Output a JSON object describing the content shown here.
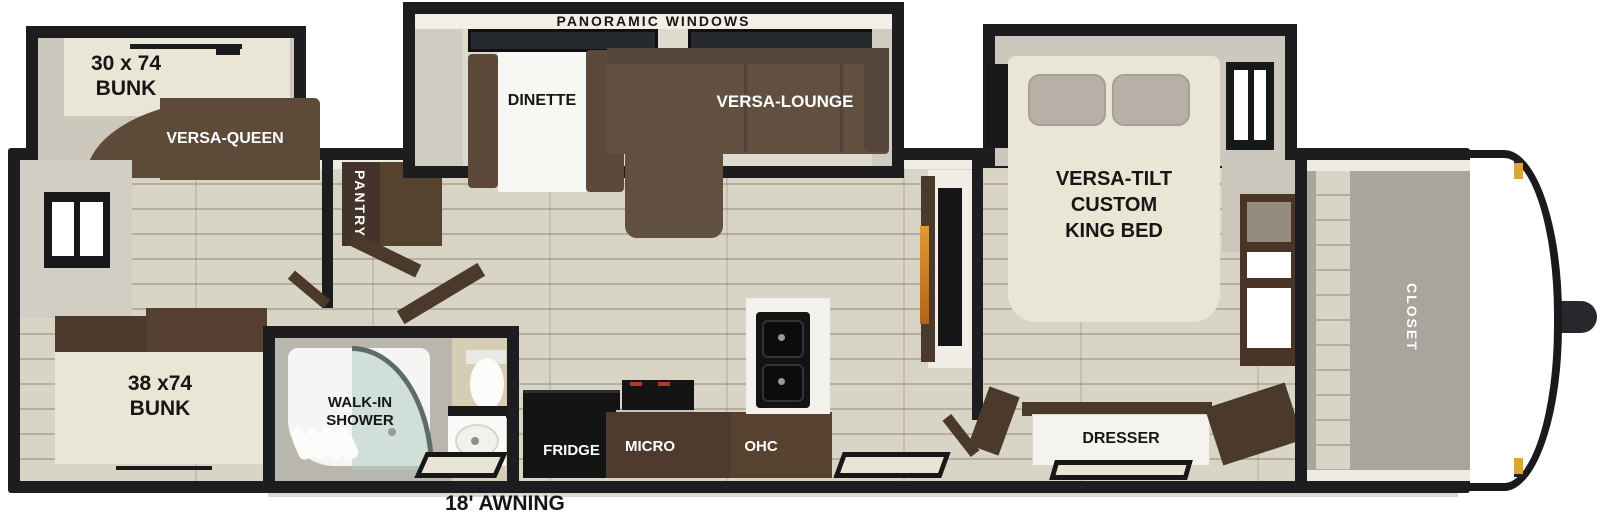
{
  "floorplan": {
    "awning_label": "18' AWNING",
    "rear_bedroom": {
      "bunk_upper_label": "30 x 74\nBUNK",
      "sofa_label": "VERSA-QUEEN",
      "bunk_lower_label": "38 x74\nBUNK"
    },
    "bathroom": {
      "shower_label": "WALK-IN\nSHOWER"
    },
    "living_area": {
      "slideout_label": "PANORAMIC WINDOWS",
      "dinette_label": "DINETTE",
      "lounge_label": "VERSA-LOUNGE",
      "pantry_label": "PANTRY"
    },
    "kitchen": {
      "fridge_label": "FRIDGE",
      "microwave_label": "MICRO",
      "overhead_cabinet_label": "OHC"
    },
    "master_bedroom": {
      "bed_label": "VERSA-TILT\nCUSTOM\nKING BED",
      "dresser_label": "DRESSER"
    },
    "front_section": {
      "closet_label": "CLOSET"
    },
    "colors": {
      "wall_black": "#1d1d1f",
      "floor_wood": "#d9d5c6",
      "sofa_brown": "#5e4a39",
      "cabinet_brown": "#4b392c",
      "bed_cream": "#eae6d5",
      "counter_white": "#f2f1ec",
      "appliance_black": "#141414",
      "shower_glass_teal": "#aecdc2",
      "fireplace_orange": "#d98a2b",
      "marker_light_amber": "#dca63e"
    }
  }
}
